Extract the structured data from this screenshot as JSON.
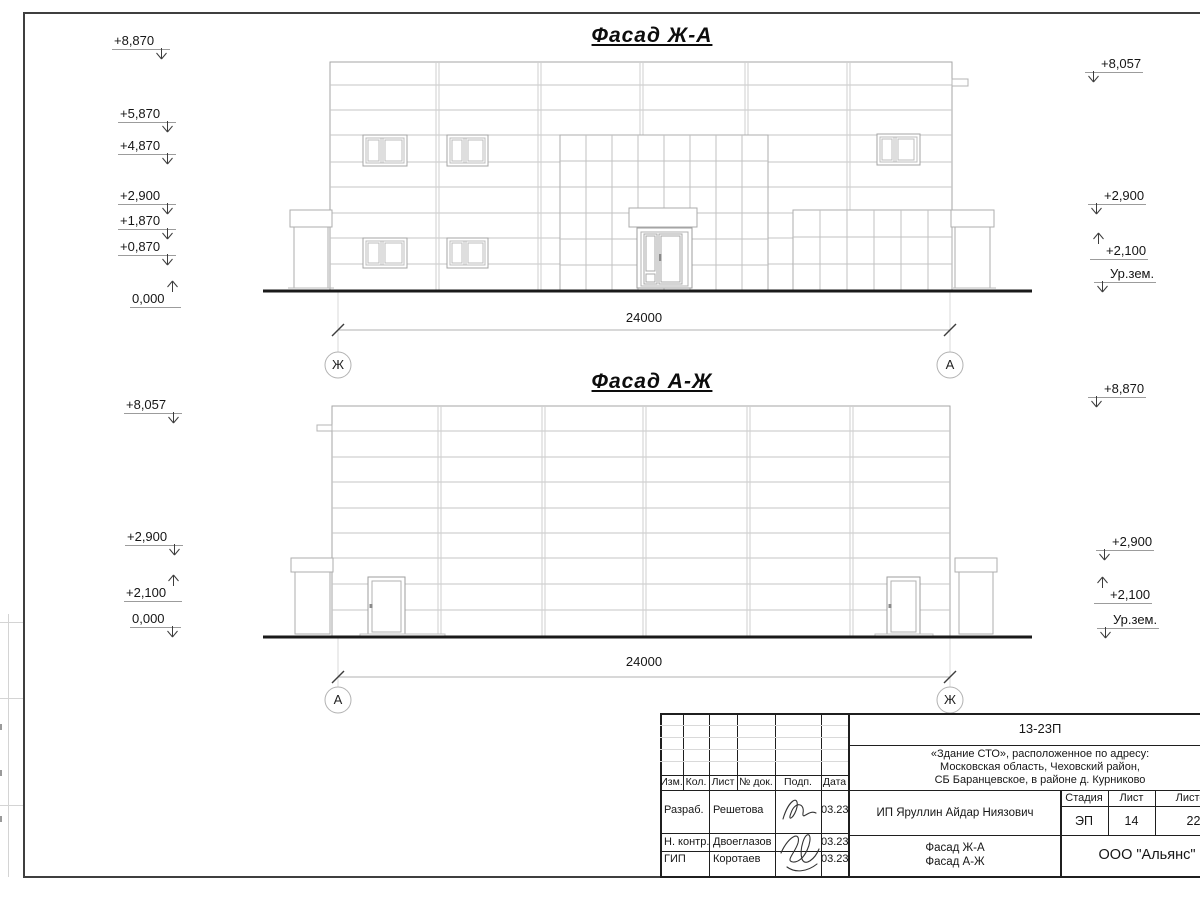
{
  "drawing": {
    "facade_top": {
      "title": "Фасад Ж-А",
      "dim": "24000",
      "axis_left": "Ж",
      "axis_right": "А",
      "marks_left": [
        "+8,870",
        "+5,870",
        "+4,870",
        "+2,900",
        "+1,870",
        "+0,870",
        "0,000"
      ],
      "marks_right": [
        "+8,057",
        "+2,900",
        "+2,100",
        "Ур.зем."
      ]
    },
    "facade_bottom": {
      "title": "Фасад А-Ж",
      "dim": "24000",
      "axis_left": "А",
      "axis_right": "Ж",
      "marks_left": [
        "+8,057",
        "+2,900",
        "+2,100",
        "0,000"
      ],
      "marks_right": [
        "+8,870",
        "+2,900",
        "+2,100",
        "Ур.зем."
      ]
    },
    "stamp": {
      "doc_number": "13-23П",
      "project_address_lines": [
        "«Здание СТО», расположенное по адресу:",
        "Московская область, Чеховский район,",
        "СБ Баранцевское, в районе д. Курниково"
      ],
      "client": "ИП Яруллин Айдар Ниязович",
      "sheet_content_lines": [
        "Фасад Ж-А",
        "Фасад А-Ж"
      ],
      "organization": "ООО \"Альянс\"",
      "stage_label": "Стадия",
      "stage_value": "ЭП",
      "sheet_label": "Лист",
      "sheet_value": "14",
      "sheets_label": "Листов",
      "sheets_value": "22",
      "columns": [
        "Изм.",
        "Кол.",
        "Лист",
        "№ док.",
        "Подп.",
        "Дата"
      ],
      "signoff": [
        {
          "role": "Разраб.",
          "name": "Решетова",
          "date": "03.23"
        },
        {
          "role": "Н. контр.",
          "name": "Двоеглазов",
          "date": "03.23"
        },
        {
          "role": "ГИП",
          "name": "Коротаев",
          "date": "03.23"
        }
      ]
    }
  }
}
